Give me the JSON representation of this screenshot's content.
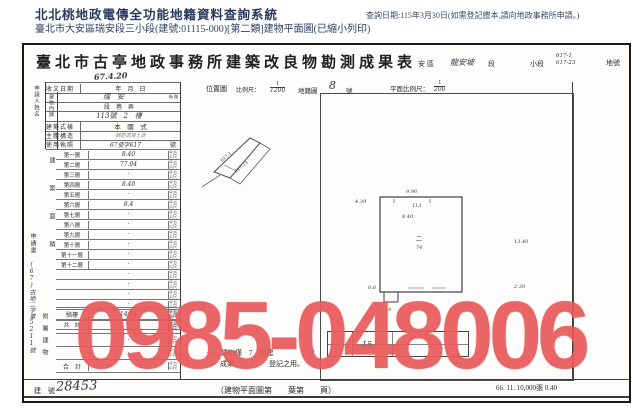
{
  "header": {
    "system_title": "北北桃地政電傳全功能地籍資料查詢系統",
    "subtitle": "臺北市大安區瑞安段三小段(建號:01115-000)[第二類]建物平面圖(已縮小列印)",
    "query_date": "查詢日期:115年3月30日(如需登記謄本,請向地政事務所申請。)"
  },
  "watermark": {
    "text": "0985-048006",
    "color": "#e8595a"
  },
  "doc": {
    "title": "臺北市古亭地政事務所建築改良物勘測成果表",
    "lot_line": {
      "prefix": "大",
      "district": "安區",
      "section_value": "龍安坡",
      "section_label": "段",
      "subsection_label": "小段",
      "lot_numbers_top": "617-1",
      "lot_numbers_bottom": "617-23",
      "lot_label": "地號"
    },
    "left_form": {
      "applicant_label": "申請人姓名",
      "received_label": "收文日期",
      "received_stamp": "67.4.20",
      "received_value": "年　月　日",
      "address_label": "建物門牌",
      "address_street_value": "瑞　安",
      "address_street_unit": "街路",
      "address_lane": "段　巷　弄",
      "address_number": "113號　2　樓",
      "style_label": "建築式樣",
      "style_value": "本　國　式",
      "structure_label": "主體構造",
      "structure_value": "鋼筋混凝土造",
      "license_label": "使用執照",
      "license_value": "67使字617",
      "license_unit": "號"
    },
    "area_table": {
      "side_label": "建築面積",
      "unit": "平方公尺",
      "floors": [
        {
          "label": "第一層",
          "value": "8.40"
        },
        {
          "label": "第二層",
          "value": "77.04"
        },
        {
          "label": "第三層",
          "value": "·"
        },
        {
          "label": "第四層",
          "value": "8.40"
        },
        {
          "label": "第五層",
          "value": "·"
        },
        {
          "label": "第六層",
          "value": "8.4"
        },
        {
          "label": "第七層",
          "value": "·"
        },
        {
          "label": "第八層",
          "value": "·"
        },
        {
          "label": "第九層",
          "value": "·"
        },
        {
          "label": "第十層",
          "value": "·"
        },
        {
          "label": "第十一層",
          "value": "·"
        },
        {
          "label": "第十二層",
          "value": "·"
        }
      ],
      "extra_values": [
        "·",
        "·",
        "·",
        "·",
        "·"
      ],
      "total_label": "共　計",
      "total_value": "·"
    },
    "margin": {
      "printed": "申請書",
      "handwritten": "(67)古地二字第5211號"
    },
    "attached": {
      "side_label": "附屬建物",
      "rows": [
        {
          "label": "騎樓",
          "value": "14.04"
        },
        {
          "label": "",
          "value": "·"
        },
        {
          "label": "",
          "value": "·"
        },
        {
          "label": "",
          "value": "·"
        }
      ],
      "total_label": "合　計",
      "total_value": ""
    },
    "map_header": {
      "label": "位置圖",
      "scale_label": "比例尺：",
      "num": "1",
      "den": "1200",
      "map_label": "地籍圖",
      "map_no": "8",
      "map_no_unit": "號"
    },
    "plan_header": {
      "label": "平面比例尺：",
      "num": "1",
      "den": "200"
    },
    "sketch": {
      "label_a": "617-1",
      "label_b": "617-23"
    },
    "plan": {
      "dim_top": "9.96",
      "dim_top_inner": "113",
      "dim_top_inner2": "8.40",
      "dim_left": "4.39",
      "dim_right": "13.40",
      "dim_right2": "2.30",
      "dim_notch": "0.8",
      "dim_bottom": "1.18",
      "center_top": "二",
      "center_bottom": "74"
    },
    "stamp_box": {
      "frag1": "15",
      "frag2": "8.2"
    },
    "notes": {
      "line1": "一、建物僅　7　層建　　　　　之",
      "line2": "成果　　　　　登記之用。"
    },
    "footer": {
      "building_no_label": "建　號",
      "building_no": "28453",
      "center": "（建物平面圖第　　葉第　　頁）",
      "print_info": "66. 11. 10,000張 0.40"
    }
  }
}
